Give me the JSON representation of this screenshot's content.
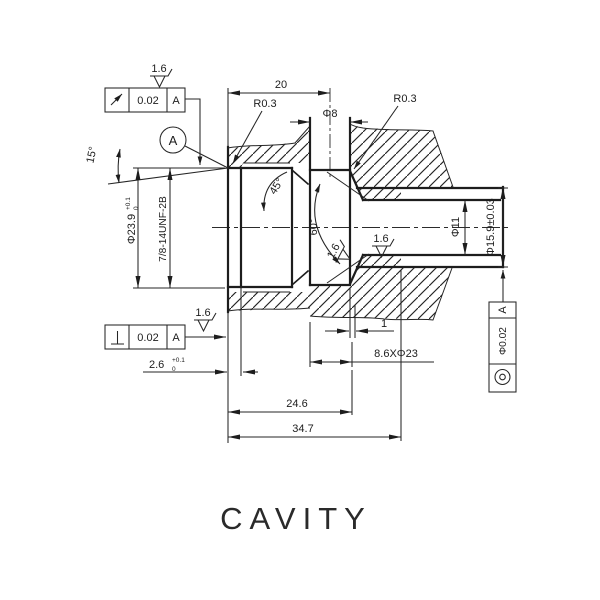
{
  "title": "CAVITY",
  "colors": {
    "line": "#1d1d1d",
    "background": "#ffffff"
  },
  "annotations": {
    "dim_20": "20",
    "r03_left": "R0.3",
    "r03_right": "R0.3",
    "dia8": "Φ8",
    "dia23_9": "Φ23.9",
    "dia23_9_tol_up": "+0.1",
    "dia23_9_tol_dn": "0",
    "thread": "7/8-14UNF-2B",
    "ang15": "15°",
    "ang45": "45°",
    "ang60": "60°",
    "dia11": "Φ11",
    "dia15_9": "Φ15.9±0.03",
    "dim_1": "1",
    "dim_8_6": "8.6XΦ23",
    "dim_2_6": "2.6",
    "dim_2_6_tol_up": "+0.1",
    "dim_2_6_tol_dn": "0",
    "dim_24_6": "24.6",
    "dim_34_7": "34.7",
    "datum": "A",
    "finish": "1.6"
  },
  "fcf": {
    "runout": {
      "symbol": "circular-runout-arrow",
      "tol": "0.02",
      "datum": "A"
    },
    "perp": {
      "symbol": "perpendicularity",
      "tol": "0.02",
      "datum": "A"
    },
    "conc": {
      "symbol": "concentricity",
      "tol": "Φ0.02",
      "datum": "A"
    }
  }
}
